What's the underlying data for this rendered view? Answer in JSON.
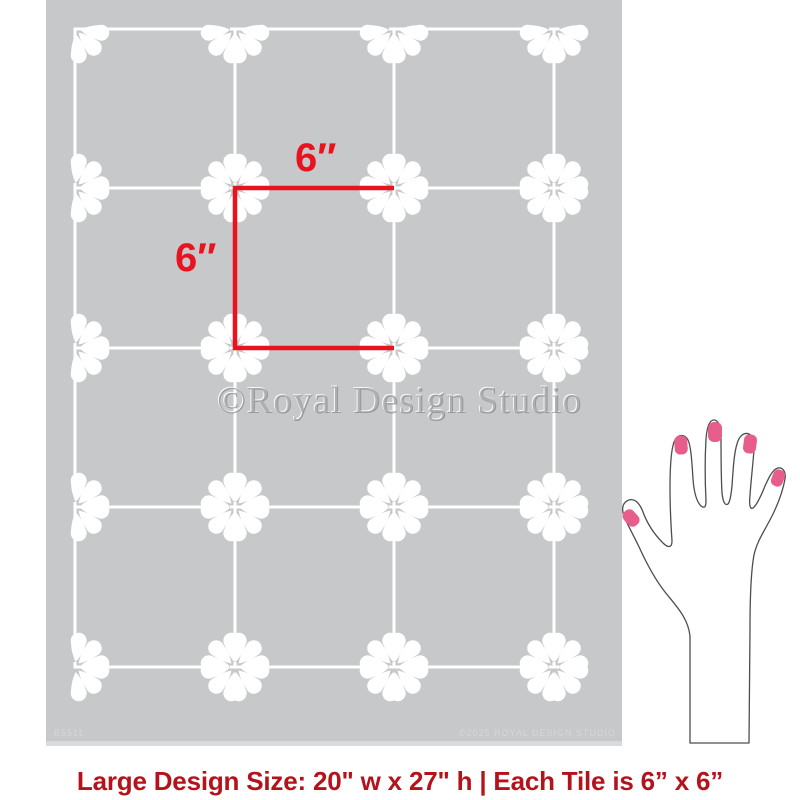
{
  "page": {
    "background": "#ffffff"
  },
  "stencil": {
    "sheet": {
      "width": 576,
      "height": 746,
      "color": "#c7c8ca",
      "edge_color": "#d9dadc"
    },
    "grid": {
      "line_color": "#ffffff",
      "line_width": 3,
      "vlines": [
        29,
        189,
        348,
        508
      ],
      "hlines": [
        29,
        188,
        348,
        507,
        667
      ],
      "bridge_gap": 5,
      "stub": 7
    },
    "motif": {
      "color": "#ffffff",
      "petal_angles": [
        8,
        45,
        82
      ],
      "tip_offset": 5
    },
    "sku_label": "B551L",
    "copyright_label": "©2025 ROYAL DESIGN STUDIO"
  },
  "annotation": {
    "color": "#e8131f",
    "stroke_width": 4.5,
    "square": {
      "x1": 189,
      "y1": 188,
      "x2": 348,
      "y2": 348
    },
    "width_label": "6″",
    "height_label": "6″"
  },
  "watermark": {
    "text": "©Royal Design Studio"
  },
  "hand": {
    "outline_color": "#4d4d50",
    "nail_color": "#e75d8c"
  },
  "caption": {
    "text": "Large Design Size: 20\" w x 27\" h | Each Tile is 6” x 6”",
    "color": "#b5121c"
  }
}
